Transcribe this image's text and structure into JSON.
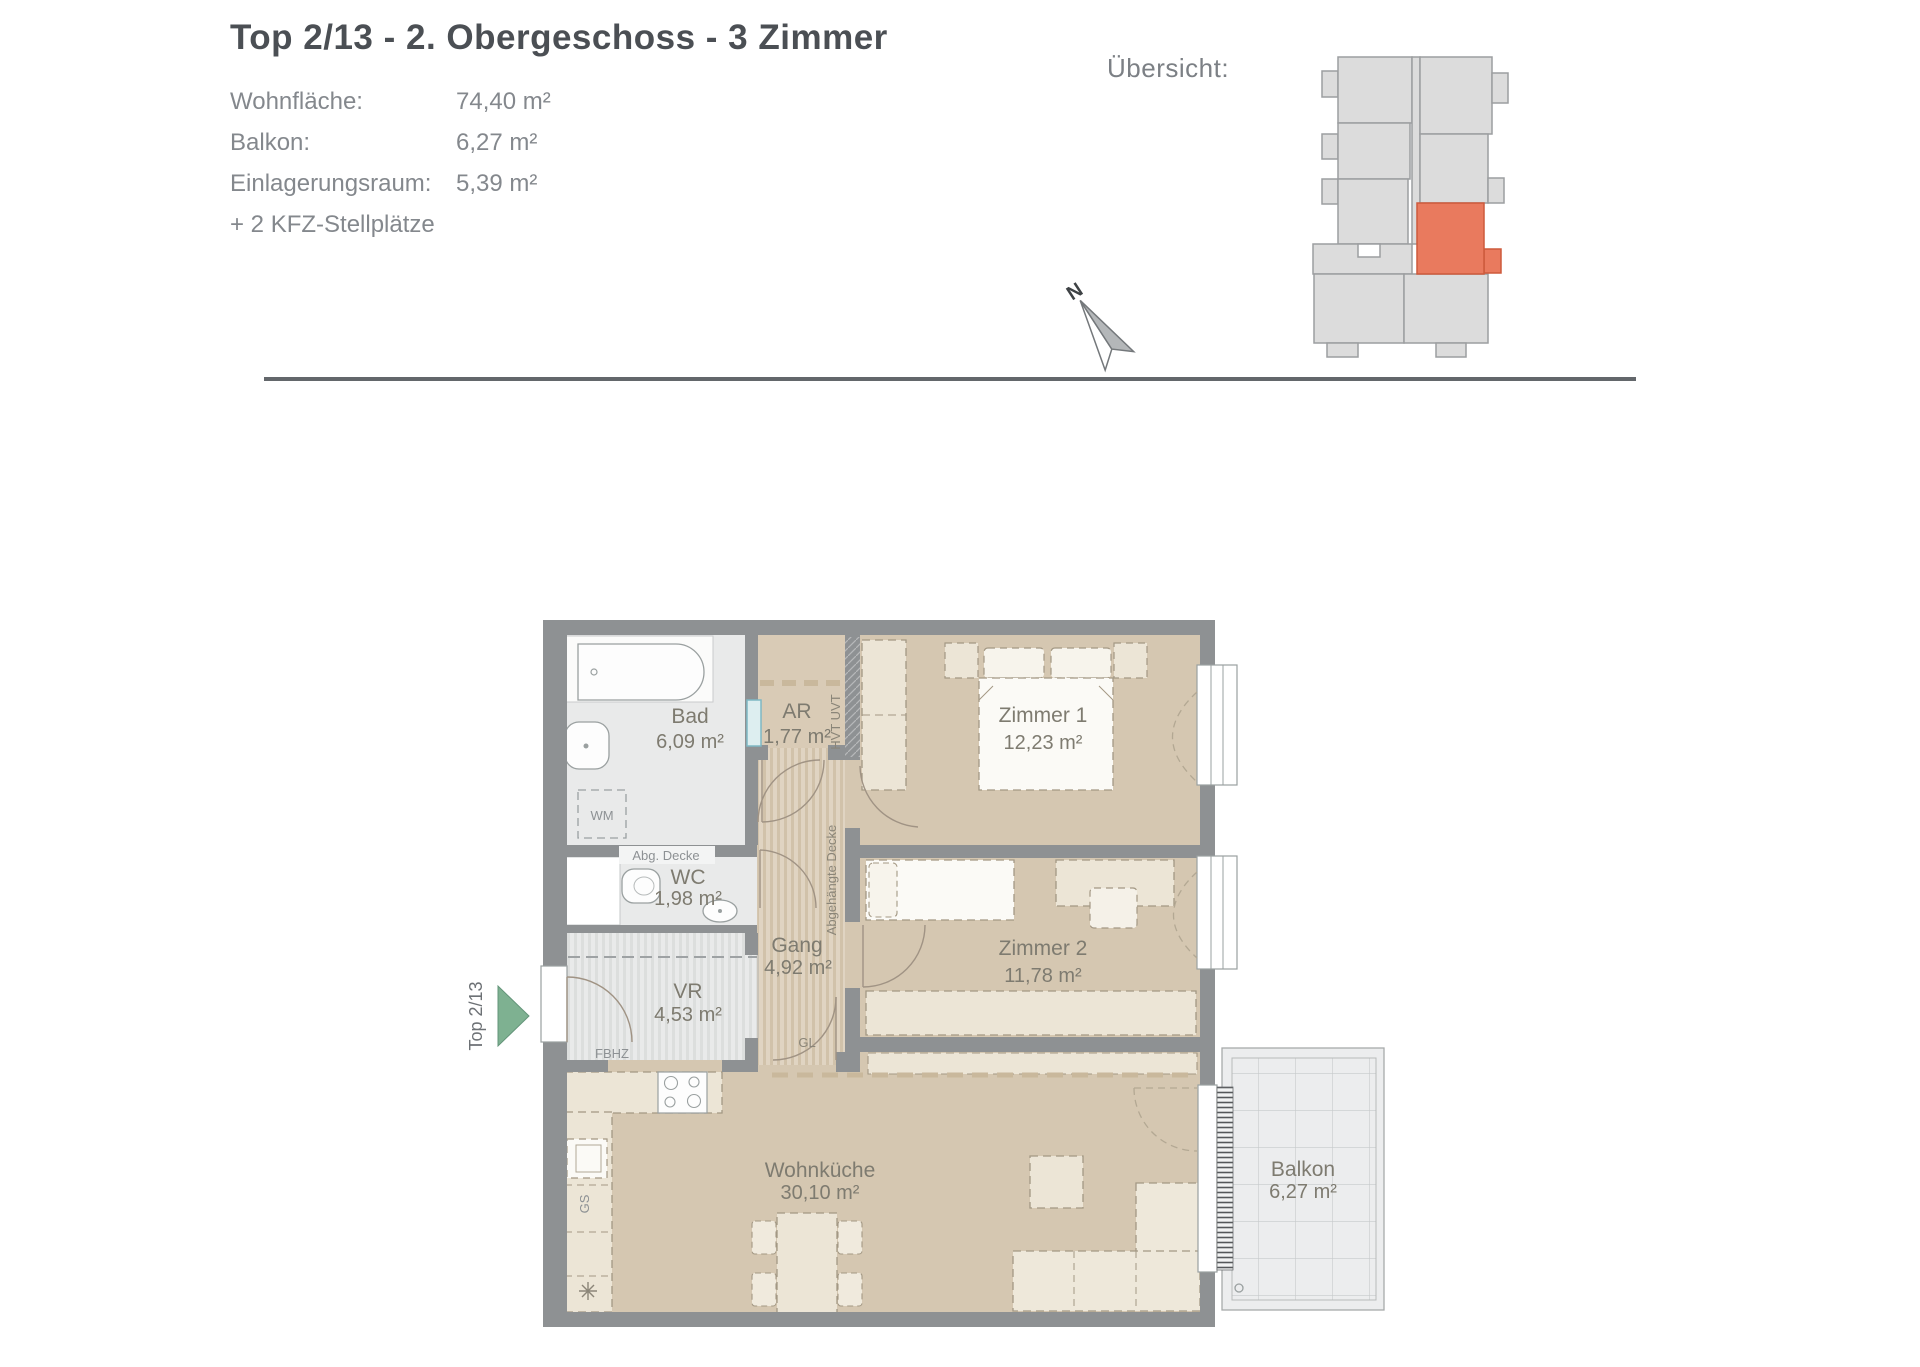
{
  "header": {
    "title": "Top 2/13 - 2. Obergeschoss - 3 Zimmer",
    "info": [
      {
        "label": "Wohnfläche:",
        "value": "74,40 m²"
      },
      {
        "label": "Balkon:",
        "value": "6,27 m²"
      },
      {
        "label": "Einlagerungsraum:",
        "value": "5,39 m²"
      },
      {
        "label": "+ 2 KFZ-Stellplätze",
        "value": ""
      }
    ],
    "overview_label": "Übersicht:"
  },
  "compass": {
    "north": "N"
  },
  "plan": {
    "unit_label": "Top 2/13",
    "rooms": {
      "bad": {
        "name": "Bad",
        "area": "6,09 m²"
      },
      "ar": {
        "name": "AR",
        "area": "1,77 m²"
      },
      "wc": {
        "name": "WC",
        "area": "1,98 m²"
      },
      "gang": {
        "name": "Gang",
        "area": "4,92 m²"
      },
      "vr": {
        "name": "VR",
        "area": "4,53 m²"
      },
      "zimmer1": {
        "name": "Zimmer 1",
        "area": "12,23 m²"
      },
      "zimmer2": {
        "name": "Zimmer 2",
        "area": "11,78 m²"
      },
      "wohnkueche": {
        "name": "Wohnküche",
        "area": "30,10 m²"
      },
      "balkon": {
        "name": "Balkon",
        "area": "6,27 m²"
      }
    },
    "annotations": {
      "abg_decke": "Abg. Decke",
      "abgehaengte_decke": "Abgehängte Decke",
      "hvt_uvt": "HVT UVT",
      "wm": "WM",
      "fbhz": "FBHZ",
      "gl": "GL",
      "gs": "GS"
    }
  },
  "colors": {
    "highlight_unit": "#e97a5e",
    "entrance_arrow": "#7eb191",
    "wall": "#8e9193",
    "room_tan": "#d5c7b1",
    "room_gray": "#e9eaea",
    "furniture_cream": "#ece5d6",
    "divider": "#63676b"
  }
}
